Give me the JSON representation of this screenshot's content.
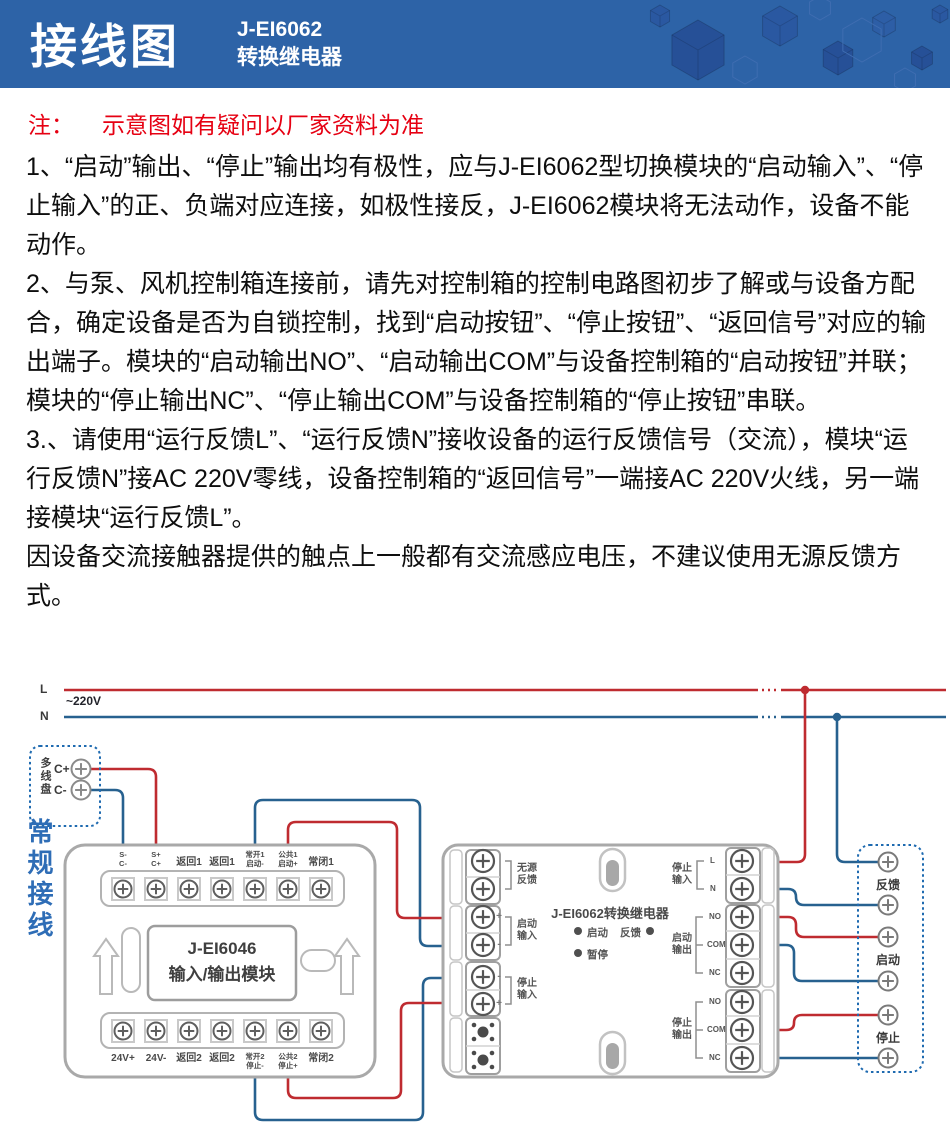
{
  "header": {
    "title": "接线图",
    "model": "J-EI6062",
    "product": "转换继电器"
  },
  "note": {
    "label": "注：",
    "text": "示意图如有疑问以厂家资料为准"
  },
  "paragraphs": [
    "1、“启动”输出、“停止”输出均有极性，应与J-EI6062型切换模块的“启动输入”、“停止输入”的正、负端对应连接，如极性接反，J-EI6062模块将无法动作，设备不能动作。",
    "2、与泵、风机控制箱连接前，请先对控制箱的控制电路图初步了解或与设备方配合，确定设备是否为自锁控制，找到“启动按钮”、“停止按钮”、“返回信号”对应的输出端子。模块的“启动输出NO”、“启动输出COM”与设备控制箱的“启动按钮”并联；模块的“停止输出NC”、“停止输出COM”与设备控制箱的“停止按钮”串联。",
    "3.、请使用“运行反馈L”、“运行反馈N”接收设备的运行反馈信号（交流），模块“运行反馈N”接AC 220V零线，设备控制箱的“返回信号”一端接AC 220V火线，另一端接模块“运行反馈L”。",
    "因设备交流接触器提供的触点上一般都有交流感应电压，不建议使用无源反馈方式。"
  ],
  "power": {
    "l": "L",
    "n": "N",
    "voltage": "~220V"
  },
  "panel": {
    "label": "多线盘",
    "c_plus": "C+",
    "c_minus": "C-"
  },
  "wiring_label": "常规接线",
  "io_module": {
    "name": "J-EI6046",
    "type": "输入/输出模块",
    "top": [
      {
        "a": "S-",
        "b": "C-"
      },
      {
        "a": "S+",
        "b": "C+"
      },
      {
        "a": "返回1"
      },
      {
        "a": "返回1"
      },
      {
        "a": "常开1",
        "b": "启动-"
      },
      {
        "a": "公共1",
        "b": "启动+"
      },
      {
        "a": "常闭1"
      }
    ],
    "bottom": [
      {
        "a": "24V+"
      },
      {
        "a": "24V-"
      },
      {
        "a": "返回2"
      },
      {
        "a": "返回2"
      },
      {
        "a": "常开2",
        "b": "停止-"
      },
      {
        "a": "公共2",
        "b": "停止+"
      },
      {
        "a": "常闭2"
      }
    ]
  },
  "relay_module": {
    "title": "J-EI6062转换继电器",
    "leds": {
      "start": "启动",
      "feedback": "反馈",
      "pause": "暂停"
    },
    "left": {
      "passive_feedback": {
        "l1": "无源",
        "l2": "反馈"
      },
      "start_input": {
        "l1": "启动",
        "l2": "输入",
        "plus": "+",
        "minus": "-"
      },
      "stop_input": {
        "l1": "停止",
        "l2": "输入",
        "plus": "+",
        "minus": "-"
      }
    },
    "right": {
      "stop_input": {
        "l1": "停止",
        "l2": "输入",
        "t1": "L",
        "t2": "N"
      },
      "start_output": {
        "l1": "启动",
        "l2": "输出",
        "no": "NO",
        "com": "COM",
        "nc": "NC"
      },
      "stop_output": {
        "l1": "停止",
        "l2": "输出",
        "no": "NO",
        "com": "COM",
        "nc": "NC"
      }
    }
  },
  "device_box": {
    "feedback": "反馈",
    "start": "启动",
    "stop": "停止"
  },
  "colors": {
    "header_blue": "#2d63a7",
    "note_red": "#e60012",
    "wire_red": "#bf2b30",
    "wire_blue": "#27618f",
    "box_blue": "#1e6ab0"
  }
}
